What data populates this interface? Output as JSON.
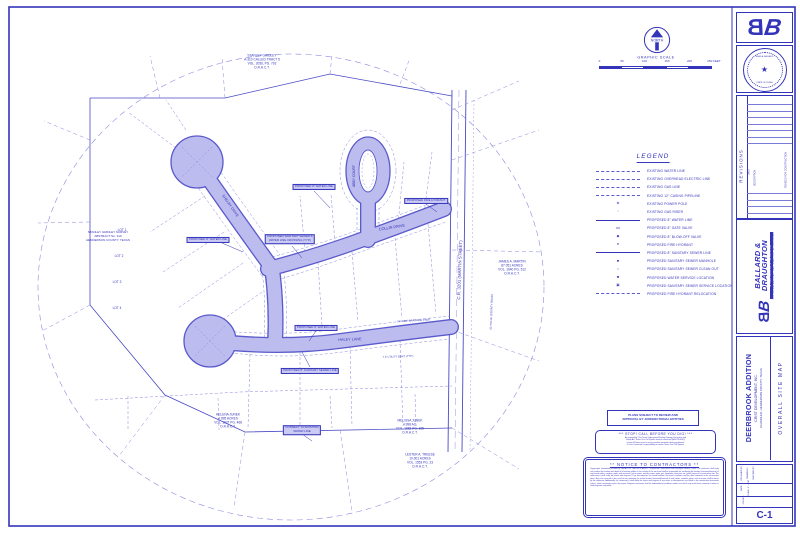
{
  "sheet": {
    "north_label": "NORTH",
    "scale_title": "GRAPHIC SCALE",
    "scale_ticks": [
      "0",
      "50",
      "100",
      "150",
      "200",
      "250 FEET"
    ]
  },
  "legend": {
    "title": "LEGEND",
    "items": [
      {
        "symbol": "dashed-line",
        "label": "EXISTING WATER LINE"
      },
      {
        "symbol": "dashed-line",
        "label": "EXISTING OVERHEAD ELECTRIC LINE"
      },
      {
        "symbol": "dashed-line",
        "label": "EXISTING GAS LINE"
      },
      {
        "symbol": "dashed-line",
        "label": "EXISTING 12\" CASING PIPELINE"
      },
      {
        "symbol": "power-pole",
        "glyph": "⊗",
        "label": "EXISTING POWER POLE"
      },
      {
        "symbol": "gas-riser",
        "glyph": "▫",
        "label": "EXISTING GAS RISER"
      },
      {
        "symbol": "solid-line",
        "label": "PROPOSED 8\" WATER LINE"
      },
      {
        "symbol": "gate-valve",
        "glyph": "⋈",
        "label": "PROPOSED 8\" GATE VALVE"
      },
      {
        "symbol": "blow-off-valve",
        "glyph": "◆",
        "label": "PROPOSED 8\" BLOW-OFF VALVE"
      },
      {
        "symbol": "fire-hydrant",
        "glyph": "●",
        "label": "PROPOSED FIRE HYDRANT"
      },
      {
        "symbol": "solid-line-bold",
        "label": "PROPOSED 8\" SANITARY SEWER LINE"
      },
      {
        "symbol": "manhole",
        "glyph": "●",
        "label": "PROPOSED SANITARY SEWER MANHOLE"
      },
      {
        "symbol": "clean-out",
        "glyph": "○",
        "label": "PROPOSED SANITARY SEWER CLEAN OUT"
      },
      {
        "symbol": "water-service",
        "glyph": "■",
        "label": "PROPOSED WATER SERVICE LOCATION"
      },
      {
        "symbol": "sewer-service",
        "glyph": "▣",
        "label": "PROPOSED SANITARY SEWER SERVICE LOCATION"
      },
      {
        "symbol": "dashed-line",
        "label": "PROPOSED FIRE HYDRANT RELOCATION"
      }
    ]
  },
  "plan": {
    "streets": {
      "collin": "COLLIN DRIVE",
      "abby": "ABBY COURT",
      "haley": "HALEY LANE",
      "shelby": "SHELBY DRIVE",
      "cr3201": "C.R. 3201 (MARTIN STREET)",
      "row": "60' R.O.W. (COUNTY ROAD)"
    },
    "lots": [
      "LOT 1",
      "LOT 2",
      "LOT 3",
      "LOT 4"
    ],
    "parcels": {
      "gridley_top": "STANLEY GRIDLEY\nA-310 CALLED TRACT 5\nVOL. 2056, PG. 792\nD.R.H.C.T.",
      "gridley_left": "STANLEY GRIDLEY SURVEY\nABSTRACT No. 310\nHENDERSON COUNTY, TEXAS",
      "junek_w": "HELENA JUNEK\n4.995 ACRES\nVOL. 1937 PG. 468\nD.R.H.C.T.",
      "junek_e": "MELISSA JUNEK\n4.998 AC.\nVOL. 1883 PG. 325\nD.R.H.C.T.",
      "treese": "LESTER A. TREESE\n10.001 ACRES\nVOL. 1553 PG. 23\nD.R.H.C.T.",
      "martin": "JAMES A. MARTIN\n87.051 ACRES\nVOL. 1640 PG. 512\nD.R.H.C.T."
    },
    "easements": {
      "drainage": "15' WIDE DRAINAGE ESMT.",
      "utility": "7.5' UTILITY ESMT. (TYP.)"
    },
    "callouts": {
      "c1": "PROPOSED 8\" WATER LINE",
      "c2": "PROPOSED FIRE HYDRANT",
      "c3": "PROPOSED SANITARY SEWER &\nWATER LINE CROSSING (TYP.)",
      "c4": "PROPOSED 8\" WATER LINE",
      "c5": "PROPOSED 8\" WATER LINE",
      "c6": "PROPOSED 8\" SANITARY SEWER LINE",
      "c7": "CONNECT TO EXISTING\nWATER LINE"
    }
  },
  "notices": {
    "review": "PLANS SUBJECT TO REVIEW AND\nAPPROVAL BY JURISDICTIONAL ENTITIES",
    "dig_title": "***   STOP!  CALL BEFORE YOU DIG!   ***",
    "dig_body": "As required by \"The Texas Underground Facility Damage Prevention and\nSafety Act\" Texas One Call System must be contacted (800-245-4545)\nat least 48 hours prior to any excavation operations being performed.\nIt is the Contractor's responsibility to contact Texas One Call System.",
    "contractors_title": "**   NOTICE  TO  CONTRACTORS   **",
    "contractors_body": "Topographic information provided by GERALD W. CARTER & ASSOC., Registered Professional Land Surveyors, Athens, Texas.  The contractor shall verify and confirm the location and depth of all existing utilities in the vicinity of the work and shall be responsible for confirming the location (horizontal/vertical) of any buried cables, conduits, pipes, and structures (storm sewer, sanitary sewer, water, gas, telephone, television, etc.) which impact the construction site.  The contractor(s) shall notify the owner and engineer if any discrepancies are found between the actual conditions and the data contained in the construction plans.  Any costs incurred as the result of not confirming the actual location (horizontal/vertical) of said cables, conduits, pipes, and structures shall be borne by the contractor.  Additionally, the contractor(s) shall notify the owner and engineer if any errors or discrepancies are found in the construction documents (plans), which seemingly impact the project.  Engineer and owner shall be indemnified of problems and/or cost which may result from contractor's failure to notify engineer and owner."
  },
  "titleblock": {
    "logo_b1": "B",
    "logo_b2": "B",
    "seal_name": "BRAD A. BALLARD",
    "seal_star": "★",
    "seal_state": "STATE OF TEXAS",
    "revisions_title": "REVISIONS",
    "rev_col_date": "DATE",
    "rev_col_desc": "DESCRIPTION",
    "rev_entry": "REVISED FOR CONSTRUCTION",
    "company_line1": "BALLARD &",
    "company_line2": "DRAUGHTON",
    "company_tag": "A PARTNERSHIP IN DESIGN",
    "company_addr": "2616 OLD BULLARD ROAD  TYLER, TEXAS 75701   TEL: (903) 509-4422",
    "project_title": "DEERBROOK ADDITION",
    "project_client": "CRIST DEVELOPMENT, INC.",
    "project_location": "CHANDLER, HENDERSON COUNTY, TEXAS",
    "sheet_title": "OVERALL SITE MAP",
    "f_designed": "DESIGNED BY:",
    "f_drawn": "DRAWN BY:",
    "f_checked": "CHECKED BY:",
    "f_date": "DATE:",
    "f_scale": "SCALE: 1\" = 100'",
    "f_job": "JOB NO.:",
    "sheet_no": "C-1"
  }
}
